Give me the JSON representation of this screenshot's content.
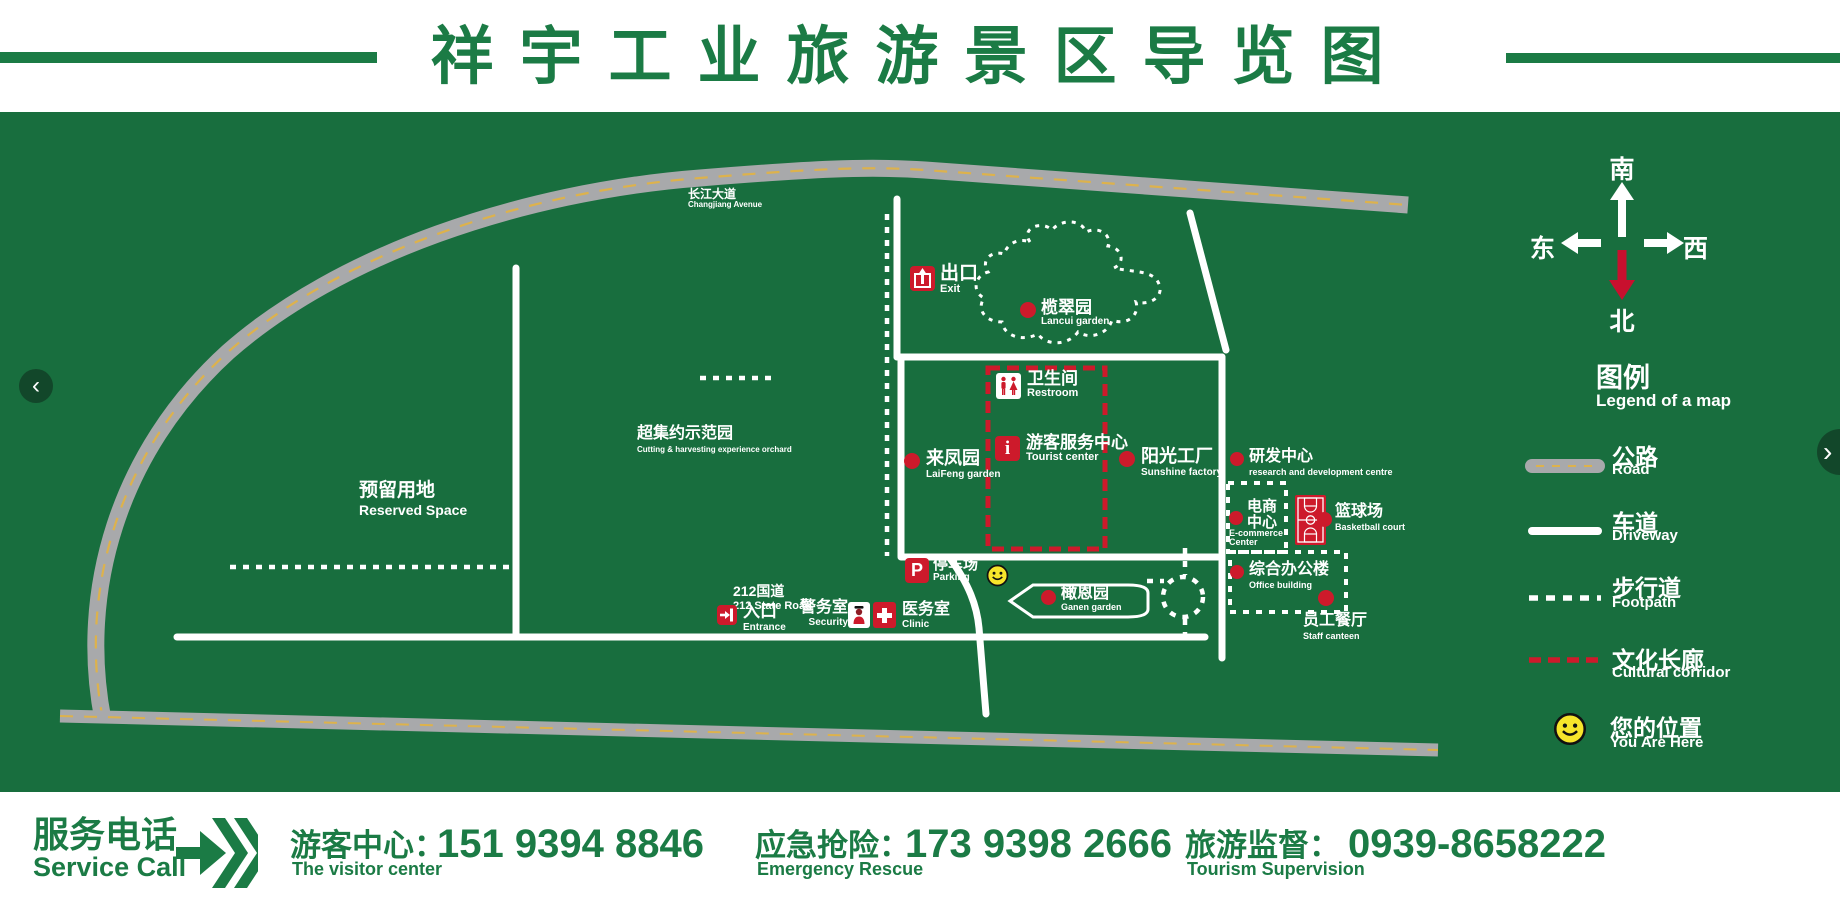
{
  "title": "祥宇工业旅游景区导览图",
  "carousel": {
    "prev": "‹",
    "next": "›"
  },
  "compass": {
    "south": "南",
    "west": "西",
    "east": "东",
    "north": "北"
  },
  "legend": {
    "heading": "图例",
    "heading_en": "Legend of a map",
    "road": {
      "label": "公路",
      "en": "Road"
    },
    "driveway": {
      "label": "车道",
      "en": "Driveway"
    },
    "footpath": {
      "label": "步行道",
      "en": "Footpath"
    },
    "corridor": {
      "label": "文化长廊",
      "en": "Cultural corridor"
    },
    "here": {
      "label": "您的位置",
      "en": "You Are Here"
    }
  },
  "map": {
    "changjiang": {
      "label": "长江大道",
      "en": "Changjiang Avenue"
    },
    "road212": {
      "label": "212国道",
      "en": "212 State Road"
    },
    "reserved": {
      "label": "预留用地",
      "en": "Reserved Space"
    },
    "orchard": {
      "label": "超集约示范园",
      "en": "Cutting & harvesting experience orchard"
    },
    "exit": {
      "label": "出口",
      "en": "Exit"
    },
    "lancui": {
      "label": "榄翠园",
      "en": "Lancui garden"
    },
    "restroom": {
      "label": "卫生间",
      "en": "Restroom"
    },
    "tourist": {
      "label": "游客服务中心",
      "en": "Tourist center",
      "glyph": "i"
    },
    "laifeng": {
      "label": "来凤园",
      "en": "LaiFeng garden"
    },
    "sunshine": {
      "label": "阳光工厂",
      "en": "Sunshine factory"
    },
    "rnd": {
      "label": "研发中心",
      "en": "research and development centre"
    },
    "ecommerce": {
      "label1": "电商",
      "label2": "中心",
      "en1": "E-commerce",
      "en2": "Center"
    },
    "basketball": {
      "label": "篮球场",
      "en": "Basketball court"
    },
    "office": {
      "label": "综合办公楼",
      "en": "Office building"
    },
    "canteen": {
      "label": "员工餐厅",
      "en": "Staff canteen"
    },
    "ganen": {
      "label": "橄恩园",
      "en": "Ganen garden"
    },
    "parking": {
      "label": "停车场",
      "en": "Parking",
      "glyph": "P"
    },
    "entrance": {
      "label": "入口",
      "en": "Entrance"
    },
    "security": {
      "label": "警务室",
      "en": "Security"
    },
    "clinic": {
      "label": "医务室",
      "en": "Clinic"
    }
  },
  "footer": {
    "service": {
      "label": "服务电话",
      "en": "Service Call"
    },
    "contacts": [
      {
        "label": "游客中心：",
        "en": "The visitor center",
        "phone": "151 9394 8846"
      },
      {
        "label": "应急抢险：",
        "en": "Emergency Rescue",
        "phone": "173 9398 2666"
      },
      {
        "label": "旅游监督：",
        "en": "Tourism Supervision",
        "phone": "0939-8658222"
      }
    ]
  },
  "colors": {
    "green": "#186e3e",
    "accent_green": "#1b7b45",
    "red": "#cd1a2b",
    "road_gray": "#a8a9ab",
    "centerline_yellow": "#ddb24c",
    "smiley_yellow": "#f7e52b"
  }
}
